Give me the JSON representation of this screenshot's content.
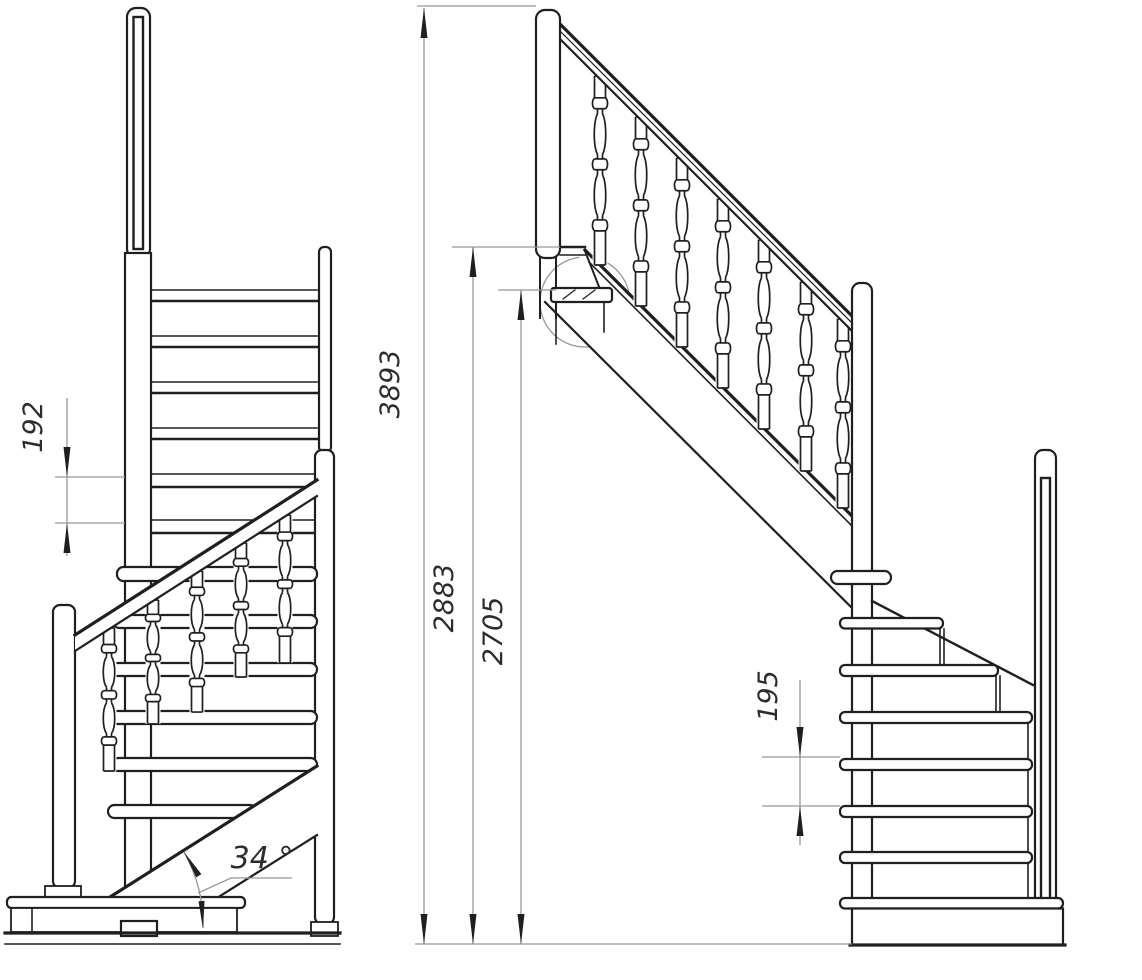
{
  "drawing": {
    "colors": {
      "line": "#1d1f20",
      "dimension": "#95989b",
      "background": "#ffffff"
    },
    "views": {
      "front": {
        "dimensions": {
          "riser_height": {
            "value": "192"
          },
          "slope_angle": {
            "value": "34 °"
          }
        }
      },
      "side": {
        "dimensions": {
          "total_rise": {
            "value": "3893"
          },
          "rise_to_landing": {
            "value": "2883"
          },
          "rise_to_winder": {
            "value": "2705"
          },
          "riser_height": {
            "value": "195"
          }
        }
      }
    }
  }
}
